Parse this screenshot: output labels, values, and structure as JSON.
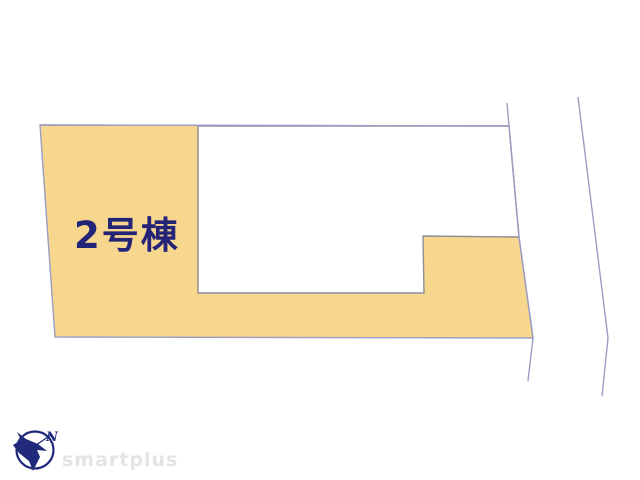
{
  "page": {
    "background_color": "#FFFFFF",
    "description": "Real estate site plan drawing of a residential lot"
  },
  "site_plan": {
    "lot": {
      "label": "2号棟",
      "fill_color": "#F7D68E",
      "boundary_color": "#9B9DC4",
      "label_color": "#232377"
    },
    "building_cutout": {
      "stroke_color": "#8E8E96",
      "fill_color": "#FFFFFF"
    },
    "road_edge": {
      "stroke_color": "#9B9DC4"
    }
  },
  "branding": {
    "watermark_text": "smartplus",
    "watermark_color": "#E4E4E4",
    "logo_color": "#20297A",
    "compass_direction_label": "N",
    "logo_icon_name": "compass-bird-icon"
  }
}
